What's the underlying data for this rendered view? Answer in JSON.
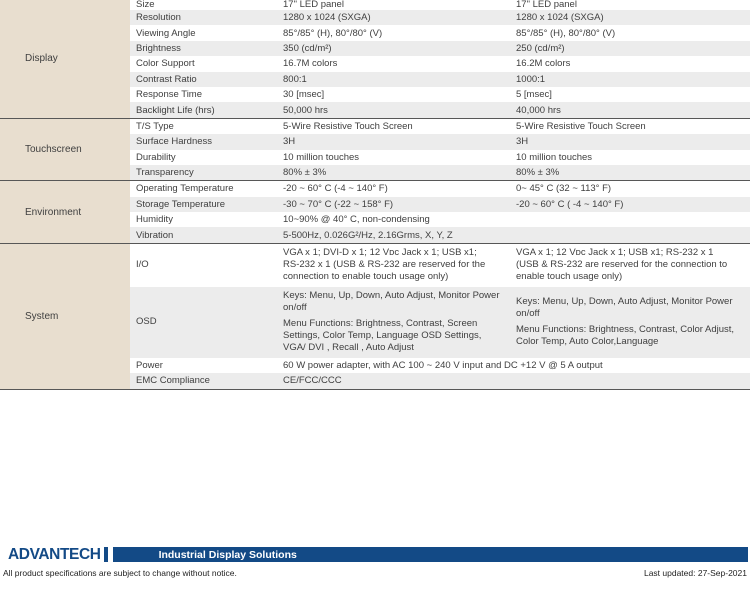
{
  "colors": {
    "brand_navy": "#134a86",
    "category_bg": "#e8decf",
    "stripe_gray": "#ececec",
    "divider_gray": "#575757"
  },
  "table": {
    "sections": [
      {
        "category": "Display",
        "rows": [
          {
            "attr": "Size",
            "col1": "17\" LED panel",
            "col2": "17\" LED panel",
            "clip": true
          },
          {
            "attr": "Resolution",
            "col1": "1280 x 1024 (SXGA)",
            "col2": "1280 x 1024 (SXGA)"
          },
          {
            "attr": "Viewing Angle",
            "col1": "85°/85° (H), 80°/80° (V)",
            "col2": "85°/85° (H), 80°/80° (V)"
          },
          {
            "attr": "Brightness",
            "col1": "350 (cd/m²)",
            "col2": "250 (cd/m²)"
          },
          {
            "attr": "Color Support",
            "col1": "16.7M colors",
            "col2": "16.2M colors"
          },
          {
            "attr": "Contrast Ratio",
            "col1": "800:1",
            "col2": "1000:1"
          },
          {
            "attr": "Response Time",
            "col1": "30 [msec]",
            "col2": "5 [msec]"
          },
          {
            "attr": "Backlight Life (hrs)",
            "col1": "50,000 hrs",
            "col2": "40,000 hrs"
          }
        ]
      },
      {
        "category": "Touchscreen",
        "rows": [
          {
            "attr": "T/S Type",
            "col1": "5-Wire Resistive Touch Screen",
            "col2": "5-Wire Resistive Touch Screen"
          },
          {
            "attr": "Surface Hardness",
            "col1": "3H",
            "col2": "3H"
          },
          {
            "attr": "Durability",
            "col1": "10 million touches",
            "col2": "10 million touches"
          },
          {
            "attr": "Transparency",
            "col1": "80% ± 3%",
            "col2": "80% ± 3%"
          }
        ]
      },
      {
        "category": "Environment",
        "rows": [
          {
            "attr": "Operating Temperature",
            "col1": "-20 ~ 60° C (-4 ~ 140° F)",
            "col2": "0~ 45° C (32 ~ 113° F)"
          },
          {
            "attr": "Storage Temperature",
            "col1": "-30 ~ 70° C (-22 ~ 158° F)",
            "col2": "-20 ~ 60° C ( -4 ~ 140° F)"
          },
          {
            "attr": "Humidity",
            "col1": "10~90% @ 40° C, non-condensing",
            "col2": ""
          },
          {
            "attr": "Vibration",
            "col1": "5-500Hz, 0.026G²/Hz, 2.16Grms, X, Y, Z",
            "col2": ""
          }
        ]
      },
      {
        "category": "System",
        "rows": [
          {
            "attr": "I/O",
            "col1": "VGA x 1; DVI-D x 1; 12 Vᴅᴄ Jack x 1; USB x1;\nRS-232 x 1 (USB & RS-232 are reserved for the\nconnection to enable touch usage only)",
            "col2": "VGA x 1; 12 Vᴅᴄ Jack x 1; USB x1; RS-232 x 1\n(USB & RS-232 are reserved for the connection to\nenable touch usage only)"
          },
          {
            "attr": "OSD",
            "col1": [
              "Keys: Menu, Up, Down, Auto Adjust, Monitor Power\non/off",
              "Menu Functions: Brightness, Contrast, Screen\nSettings, Color Temp, Language  OSD Settings,\nVGA/ DVI , Recall , Auto Adjust"
            ],
            "col2": [
              "Keys: Menu, Up, Down, Auto Adjust, Monitor Power\non/off",
              "Menu Functions: Brightness, Contrast, Color Adjust,\nColor Temp, Auto Color,Language"
            ]
          },
          {
            "attr": "Power",
            "span": true,
            "col1": "60 W power adapter, with AC 100 ~ 240 V input and DC +12 V @ 5 A output"
          },
          {
            "attr": "EMC Compliance",
            "col1": "CE/FCC/CCC",
            "col2": ""
          }
        ]
      }
    ]
  },
  "footer": {
    "brand": "ADVANTECH",
    "tagline": "Industrial Display Solutions",
    "disclaimer": "All product specifications are subject to change without notice.",
    "last_updated": "Last updated: 27-Sep-2021"
  }
}
